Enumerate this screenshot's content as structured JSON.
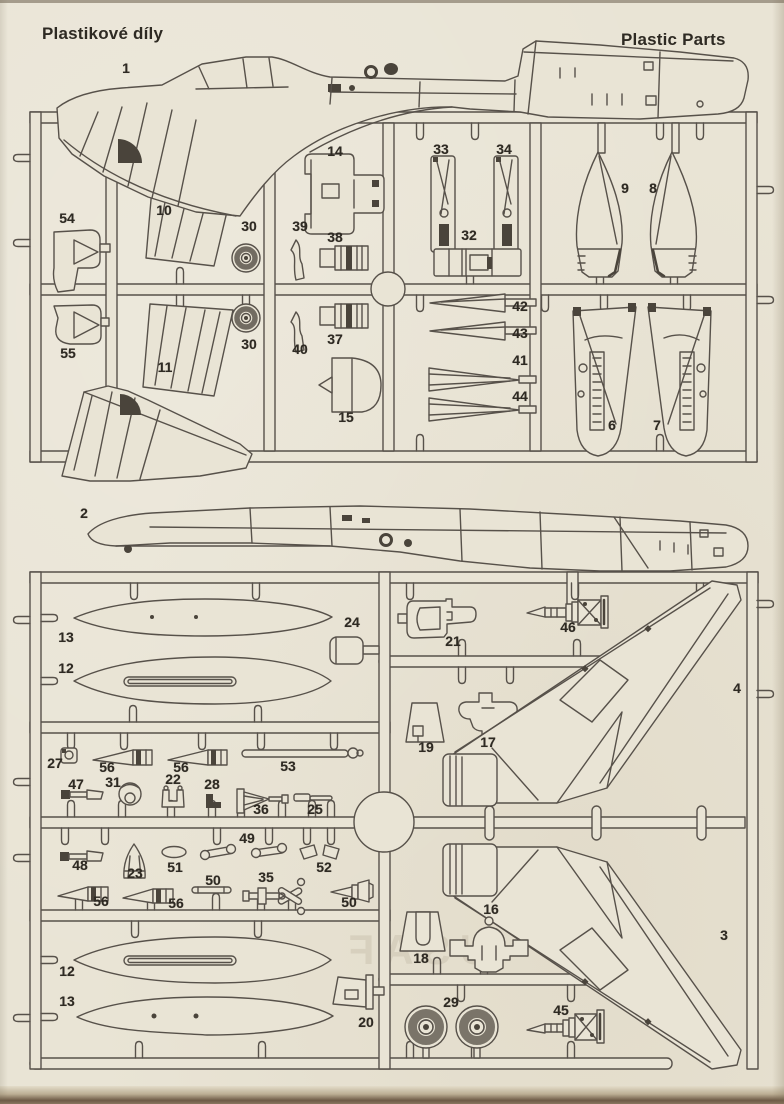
{
  "page": {
    "title_left": "Plastikové díly",
    "title_right": "Plastic Parts"
  },
  "ghost_text": "USAF",
  "colors": {
    "paper": "#e9e4d5",
    "line": "#57514a",
    "dark": "#4a443b",
    "label": "#2e2a23"
  },
  "part_labels": [
    {
      "part": "1",
      "x": 126,
      "y": 68
    },
    {
      "part": "14",
      "x": 335,
      "y": 151
    },
    {
      "part": "33",
      "x": 441,
      "y": 149
    },
    {
      "part": "34",
      "x": 504,
      "y": 149
    },
    {
      "part": "9",
      "x": 625,
      "y": 188
    },
    {
      "part": "8",
      "x": 653,
      "y": 188
    },
    {
      "part": "10",
      "x": 164,
      "y": 210
    },
    {
      "part": "54",
      "x": 67,
      "y": 218
    },
    {
      "part": "30",
      "x": 249,
      "y": 226
    },
    {
      "part": "39",
      "x": 300,
      "y": 226
    },
    {
      "part": "38",
      "x": 335,
      "y": 237
    },
    {
      "part": "32",
      "x": 469,
      "y": 235
    },
    {
      "part": "42",
      "x": 520,
      "y": 306
    },
    {
      "part": "43",
      "x": 520,
      "y": 333
    },
    {
      "part": "30",
      "x": 249,
      "y": 344
    },
    {
      "part": "55",
      "x": 68,
      "y": 353
    },
    {
      "part": "40",
      "x": 300,
      "y": 349
    },
    {
      "part": "37",
      "x": 335,
      "y": 339
    },
    {
      "part": "41",
      "x": 520,
      "y": 360
    },
    {
      "part": "11",
      "x": 165,
      "y": 367
    },
    {
      "part": "44",
      "x": 520,
      "y": 396
    },
    {
      "part": "15",
      "x": 346,
      "y": 417
    },
    {
      "part": "6",
      "x": 612,
      "y": 425
    },
    {
      "part": "7",
      "x": 657,
      "y": 425
    },
    {
      "part": "2",
      "x": 84,
      "y": 513
    },
    {
      "part": "13",
      "x": 66,
      "y": 637
    },
    {
      "part": "24",
      "x": 352,
      "y": 622
    },
    {
      "part": "46",
      "x": 568,
      "y": 627
    },
    {
      "part": "21",
      "x": 453,
      "y": 641
    },
    {
      "part": "12",
      "x": 66,
      "y": 668
    },
    {
      "part": "4",
      "x": 737,
      "y": 688
    },
    {
      "part": "19",
      "x": 426,
      "y": 747
    },
    {
      "part": "17",
      "x": 488,
      "y": 742
    },
    {
      "part": "27",
      "x": 55,
      "y": 763
    },
    {
      "part": "56",
      "x": 107,
      "y": 767
    },
    {
      "part": "56",
      "x": 181,
      "y": 767
    },
    {
      "part": "53",
      "x": 288,
      "y": 766
    },
    {
      "part": "47",
      "x": 76,
      "y": 784
    },
    {
      "part": "31",
      "x": 113,
      "y": 782
    },
    {
      "part": "22",
      "x": 173,
      "y": 779
    },
    {
      "part": "28",
      "x": 212,
      "y": 784
    },
    {
      "part": "36",
      "x": 261,
      "y": 809
    },
    {
      "part": "25",
      "x": 315,
      "y": 809
    },
    {
      "part": "49",
      "x": 247,
      "y": 838
    },
    {
      "part": "48",
      "x": 80,
      "y": 865
    },
    {
      "part": "23",
      "x": 135,
      "y": 873
    },
    {
      "part": "51",
      "x": 175,
      "y": 867
    },
    {
      "part": "52",
      "x": 324,
      "y": 867
    },
    {
      "part": "50",
      "x": 213,
      "y": 880
    },
    {
      "part": "35",
      "x": 266,
      "y": 877
    },
    {
      "part": "56",
      "x": 101,
      "y": 901
    },
    {
      "part": "56",
      "x": 176,
      "y": 903
    },
    {
      "part": "50",
      "x": 349,
      "y": 902
    },
    {
      "part": "3",
      "x": 724,
      "y": 935
    },
    {
      "part": "18",
      "x": 421,
      "y": 958
    },
    {
      "part": "16",
      "x": 491,
      "y": 909
    },
    {
      "part": "12",
      "x": 67,
      "y": 971
    },
    {
      "part": "13",
      "x": 67,
      "y": 1001
    },
    {
      "part": "29",
      "x": 451,
      "y": 1002
    },
    {
      "part": "45",
      "x": 561,
      "y": 1010
    },
    {
      "part": "20",
      "x": 366,
      "y": 1022
    }
  ]
}
